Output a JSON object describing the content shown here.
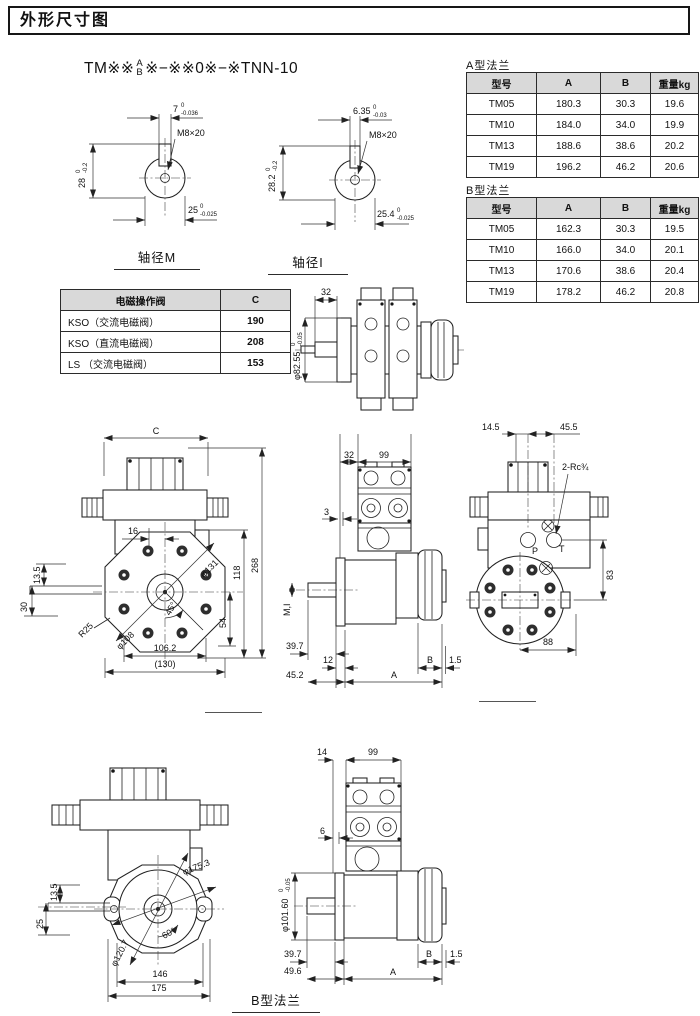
{
  "page": {
    "title": "外形尺寸图"
  },
  "model": {
    "prefix": "TM※※",
    "stack_top": "A",
    "stack_bottom": "B",
    "suffix": "※−※※0※−※TNN-10"
  },
  "tables": {
    "flange_a": {
      "caption": "A型法兰",
      "headers": [
        "型号",
        "A",
        "B",
        "重量kg"
      ],
      "rows": [
        [
          "TM05",
          "180.3",
          "30.3",
          "19.6"
        ],
        [
          "TM10",
          "184.0",
          "34.0",
          "19.9"
        ],
        [
          "TM13",
          "188.6",
          "38.6",
          "20.2"
        ],
        [
          "TM19",
          "196.2",
          "46.2",
          "20.6"
        ]
      ]
    },
    "flange_b": {
      "caption": "B型法兰",
      "headers": [
        "型号",
        "A",
        "B",
        "重量kg"
      ],
      "rows": [
        [
          "TM05",
          "162.3",
          "30.3",
          "19.5"
        ],
        [
          "TM10",
          "166.0",
          "34.0",
          "20.1"
        ],
        [
          "TM13",
          "170.6",
          "38.6",
          "20.4"
        ],
        [
          "TM19",
          "178.2",
          "46.2",
          "20.8"
        ]
      ]
    },
    "solenoid": {
      "headers": [
        "电磁操作阀",
        "C"
      ],
      "rows": [
        [
          "KSO（交流电磁阀）",
          "190"
        ],
        [
          "KSO（直流电磁阀）",
          "208"
        ],
        [
          "LS （交流电磁阀）",
          "153"
        ]
      ]
    }
  },
  "drawings": {
    "shaft_m": {
      "caption": "轴径M",
      "key_width": "7",
      "key_width_hi": "0",
      "key_width_lo": "-0.036",
      "height": "28",
      "height_hi": "0",
      "height_lo": "-0.2",
      "thread": "M8×20",
      "dia": "25",
      "dia_hi": "0",
      "dia_lo": "-0.025"
    },
    "shaft_i": {
      "caption": "轴径I",
      "key_width": "6.35",
      "key_width_hi": "0",
      "key_width_lo": "-0.03",
      "height": "28.2",
      "height_hi": "0",
      "height_lo": "-0.2",
      "thread": "M8×20",
      "dia": "25.4",
      "dia_hi": "0",
      "dia_lo": "-0.025"
    },
    "top_view": {
      "dim_32": "32",
      "dia": "φ82.55",
      "dia_hi": "0",
      "dia_lo": "-0.05"
    },
    "front_a": {
      "dim_c": "C",
      "dim_16": "16",
      "dim_13_5": "13.5",
      "dim_30": "30",
      "r25": "R25",
      "dia_108": "φ108",
      "dia_131": "φ131",
      "angle": "45°",
      "dim_54": "54",
      "dim_118": "118",
      "dim_268": "268",
      "dim_106_2": "106.2",
      "dim_130": "(130)"
    },
    "side_a": {
      "dim_32": "32",
      "dim_99": "99",
      "dim_3": "3",
      "shaft": "M,I",
      "dim_39_7": "39.7",
      "dim_12": "12",
      "dim_45_2": "45.2",
      "dim_a": "A",
      "dim_b": "B",
      "dim_1_5": "1.5"
    },
    "rear_a": {
      "dim_14_5": "14.5",
      "dim_45_5": "45.5",
      "ports": "2-Rc¾",
      "port_p": "P",
      "port_t": "T",
      "dim_83": "83",
      "dim_88": "88"
    },
    "front_b": {
      "dim_13_5": "13.5",
      "dim_25": "25",
      "dia_175_3": "φ175.3",
      "dia_120_7": "φ120.7",
      "angle": "60°",
      "dim_146": "146",
      "dim_175": "175"
    },
    "side_b": {
      "caption": "B型法兰",
      "dim_14": "14",
      "dim_99": "99",
      "dim_6": "6",
      "dia": "φ101.60",
      "dia_hi": "0",
      "dia_lo": "-0.05",
      "dim_39_7": "39.7",
      "dim_49_6": "49.6",
      "dim_a": "A",
      "dim_b": "B",
      "dim_1_5": "1.5"
    }
  }
}
